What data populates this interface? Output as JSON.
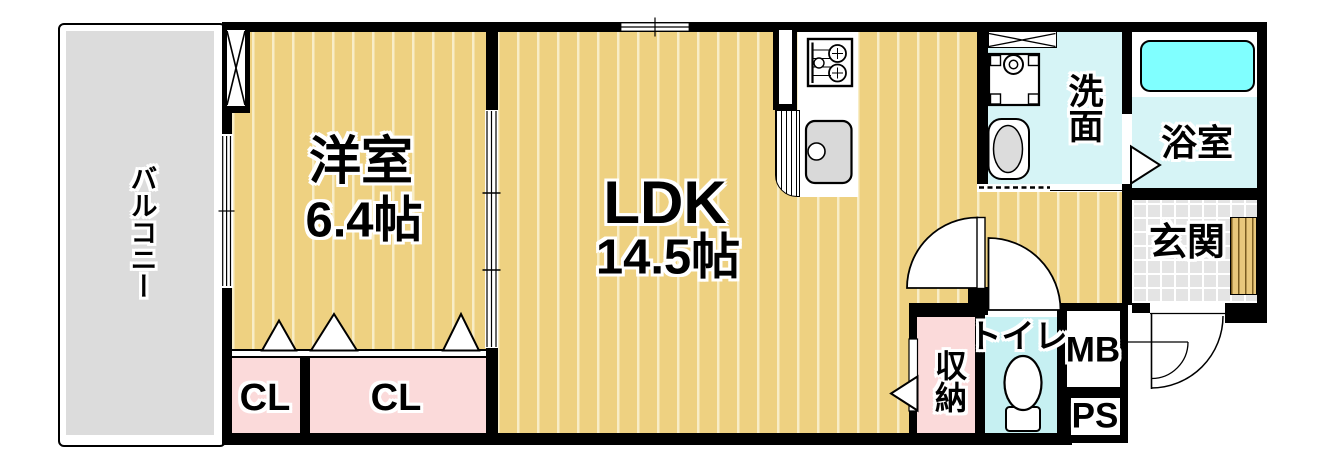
{
  "floorplan": {
    "balcony": {
      "label": "バルコニー"
    },
    "western_room": {
      "label": "洋室",
      "size": "6.4帖"
    },
    "ldk": {
      "label": "LDK",
      "size": "14.5帖"
    },
    "closets": [
      {
        "label": "CL"
      },
      {
        "label": "CL"
      }
    ],
    "washroom": {
      "label": "洗面"
    },
    "bathroom": {
      "label": "浴室"
    },
    "entrance": {
      "label": "玄関"
    },
    "storage": {
      "label": "収納"
    },
    "toilet": {
      "label": "トイレ"
    },
    "meter_box": {
      "label": "MB"
    },
    "pipe_space": {
      "label": "PS"
    },
    "colors": {
      "wall": "#000000",
      "floor_tan": "#eed181",
      "floor_stripe": "#f8edc6",
      "closet_pink": "#fbdada",
      "washroom_cyan": "#d6f4f6",
      "toilet_cyan": "#c6f0f2",
      "bathtub_cyan": "#80ffff",
      "balcony_gray": "#dcdcdc",
      "entrance_tile_gray": "#e4e4e4",
      "wood_step": "#e9c87c"
    },
    "icons": {
      "kitchen": [
        "gas-stove-icon",
        "kitchen-sink-icon"
      ],
      "washroom": [
        "washing-machine-pan-icon",
        "washbasin-icon"
      ],
      "toilet": [
        "toilet-bowl-icon"
      ],
      "bathroom": [
        "bathtub-icon"
      ],
      "doors": [
        "door-swing-arc",
        "folding-door-triangle",
        "sliding-door-track",
        "window-double-line"
      ]
    }
  }
}
